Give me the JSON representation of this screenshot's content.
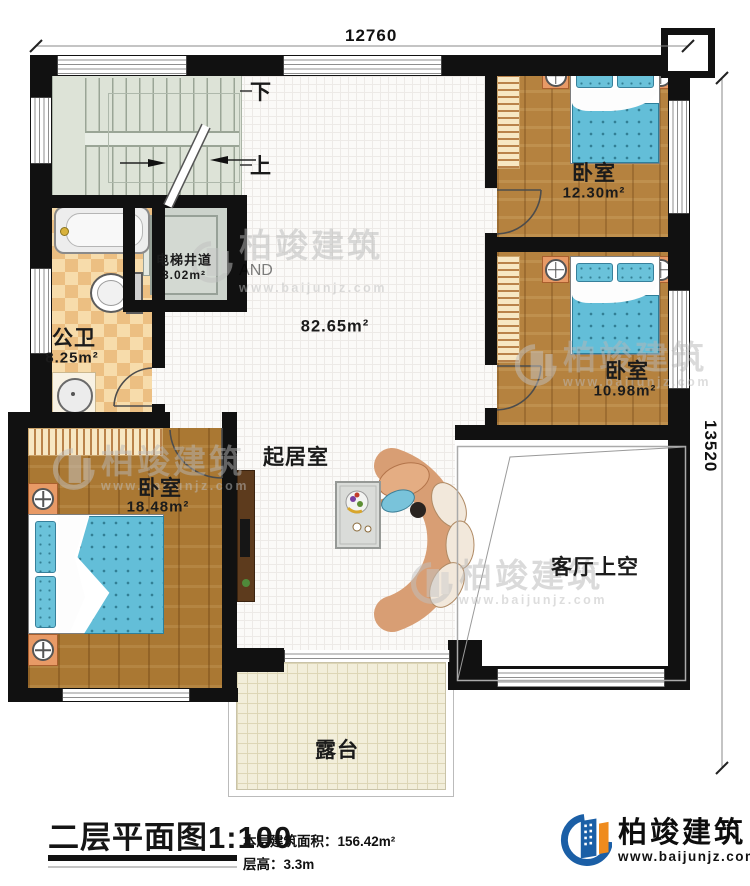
{
  "dimensions": {
    "top": "12760",
    "right": "13520"
  },
  "stairs": {
    "down": "下",
    "up": "上"
  },
  "rooms": {
    "elevator": {
      "name": "电梯井道",
      "area": "3.02m²"
    },
    "bathroom": {
      "name": "公卫",
      "area": "8.25m²"
    },
    "hall": {
      "name": "起居室",
      "area": "82.65m²"
    },
    "bedroom1": {
      "name": "卧室",
      "area": "12.30m²"
    },
    "bedroom2": {
      "name": "卧室",
      "area": "10.98m²"
    },
    "bedroom3": {
      "name": "卧室",
      "area": "18.48m²"
    },
    "living_void": {
      "name": "客厅上空"
    },
    "terrace": {
      "name": "露台"
    }
  },
  "caption": {
    "title": "二层平面图",
    "scale": "1:100",
    "floor_area": "本层建筑面积：156.42m²",
    "floor_height": "层高：3.3m"
  },
  "logo": {
    "company": "柏竣建筑",
    "website": "www.baijunjz.com"
  },
  "watermark": {
    "company": "柏竣建筑",
    "website": "www.baijunjz.com"
  },
  "colors": {
    "wall": "#111111",
    "logo_blue": "#1b5fa6",
    "logo_orange": "#ef8b1d",
    "bed_blue": "#63bed8",
    "wood": "#b5823f"
  }
}
